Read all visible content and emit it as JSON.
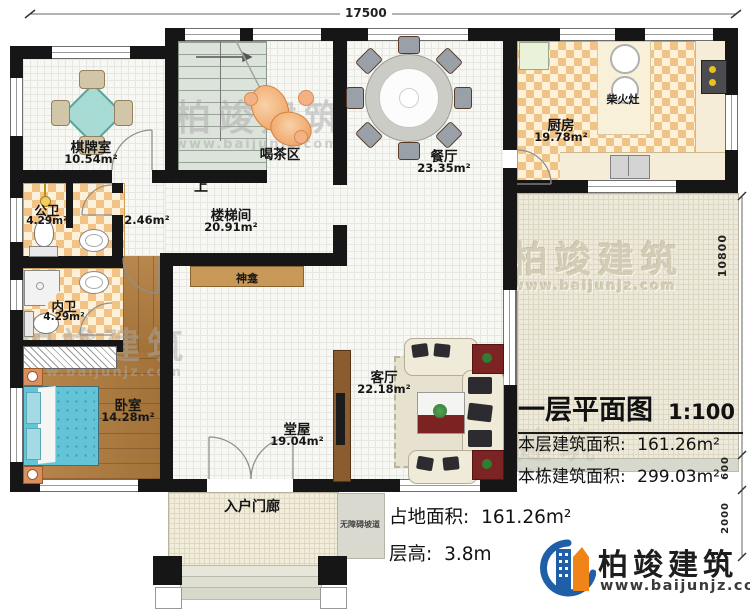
{
  "dimensions": {
    "top_width": "17500",
    "right_height": "10800",
    "right_step": "600",
    "right_porch": "2000"
  },
  "rooms": {
    "qipaishi": {
      "name": "棋牌室",
      "area": "10.54m²"
    },
    "hechaqu": {
      "name": "喝茶区"
    },
    "canting": {
      "name": "餐厅",
      "area": "23.35m²"
    },
    "chufang": {
      "name": "厨房",
      "area": "19.78m²"
    },
    "loutijian": {
      "name": "楼梯间",
      "area": "20.91m²"
    },
    "understair": {
      "area": "2.46m²"
    },
    "gongwei": {
      "name": "公卫",
      "area": "4.29m²"
    },
    "neiwei": {
      "name": "内卫",
      "area": "4.29m²"
    },
    "woshi": {
      "name": "卧室",
      "area": "14.28m²"
    },
    "tangwu": {
      "name": "堂屋",
      "area": "19.04m²"
    },
    "keting": {
      "name": "客厅",
      "area": "22.18m²"
    },
    "menlang": {
      "name": "入户门廊"
    }
  },
  "features": {
    "up": "上",
    "shrine": "神龛",
    "wood_stove": "柴火灶",
    "ramp": "无障碍坡道"
  },
  "title_block": {
    "title": "一层平面图",
    "scale": "1:100",
    "lines": [
      {
        "label": "本层建筑面积:",
        "value": "161.26m²"
      },
      {
        "label": "本栋建筑面积:",
        "value": "299.03m²"
      }
    ],
    "site_area_label": "占地面积:",
    "site_area_value": "161.26m²",
    "storey_label": "层高:",
    "storey_value": "3.8m"
  },
  "brand": {
    "name": "柏竣建筑",
    "website": "www.baijunjz.com"
  },
  "watermark": {
    "name": "柏竣建筑",
    "website": "www.baijunjz.com"
  },
  "colors": {
    "wall": "#161616",
    "accent_blue": "#1f5fa8",
    "accent_orange": "#f08418",
    "checker_tile": "#f2c386",
    "wood_floor": "#ad7c45",
    "bed_blue": "#62c4d6"
  }
}
